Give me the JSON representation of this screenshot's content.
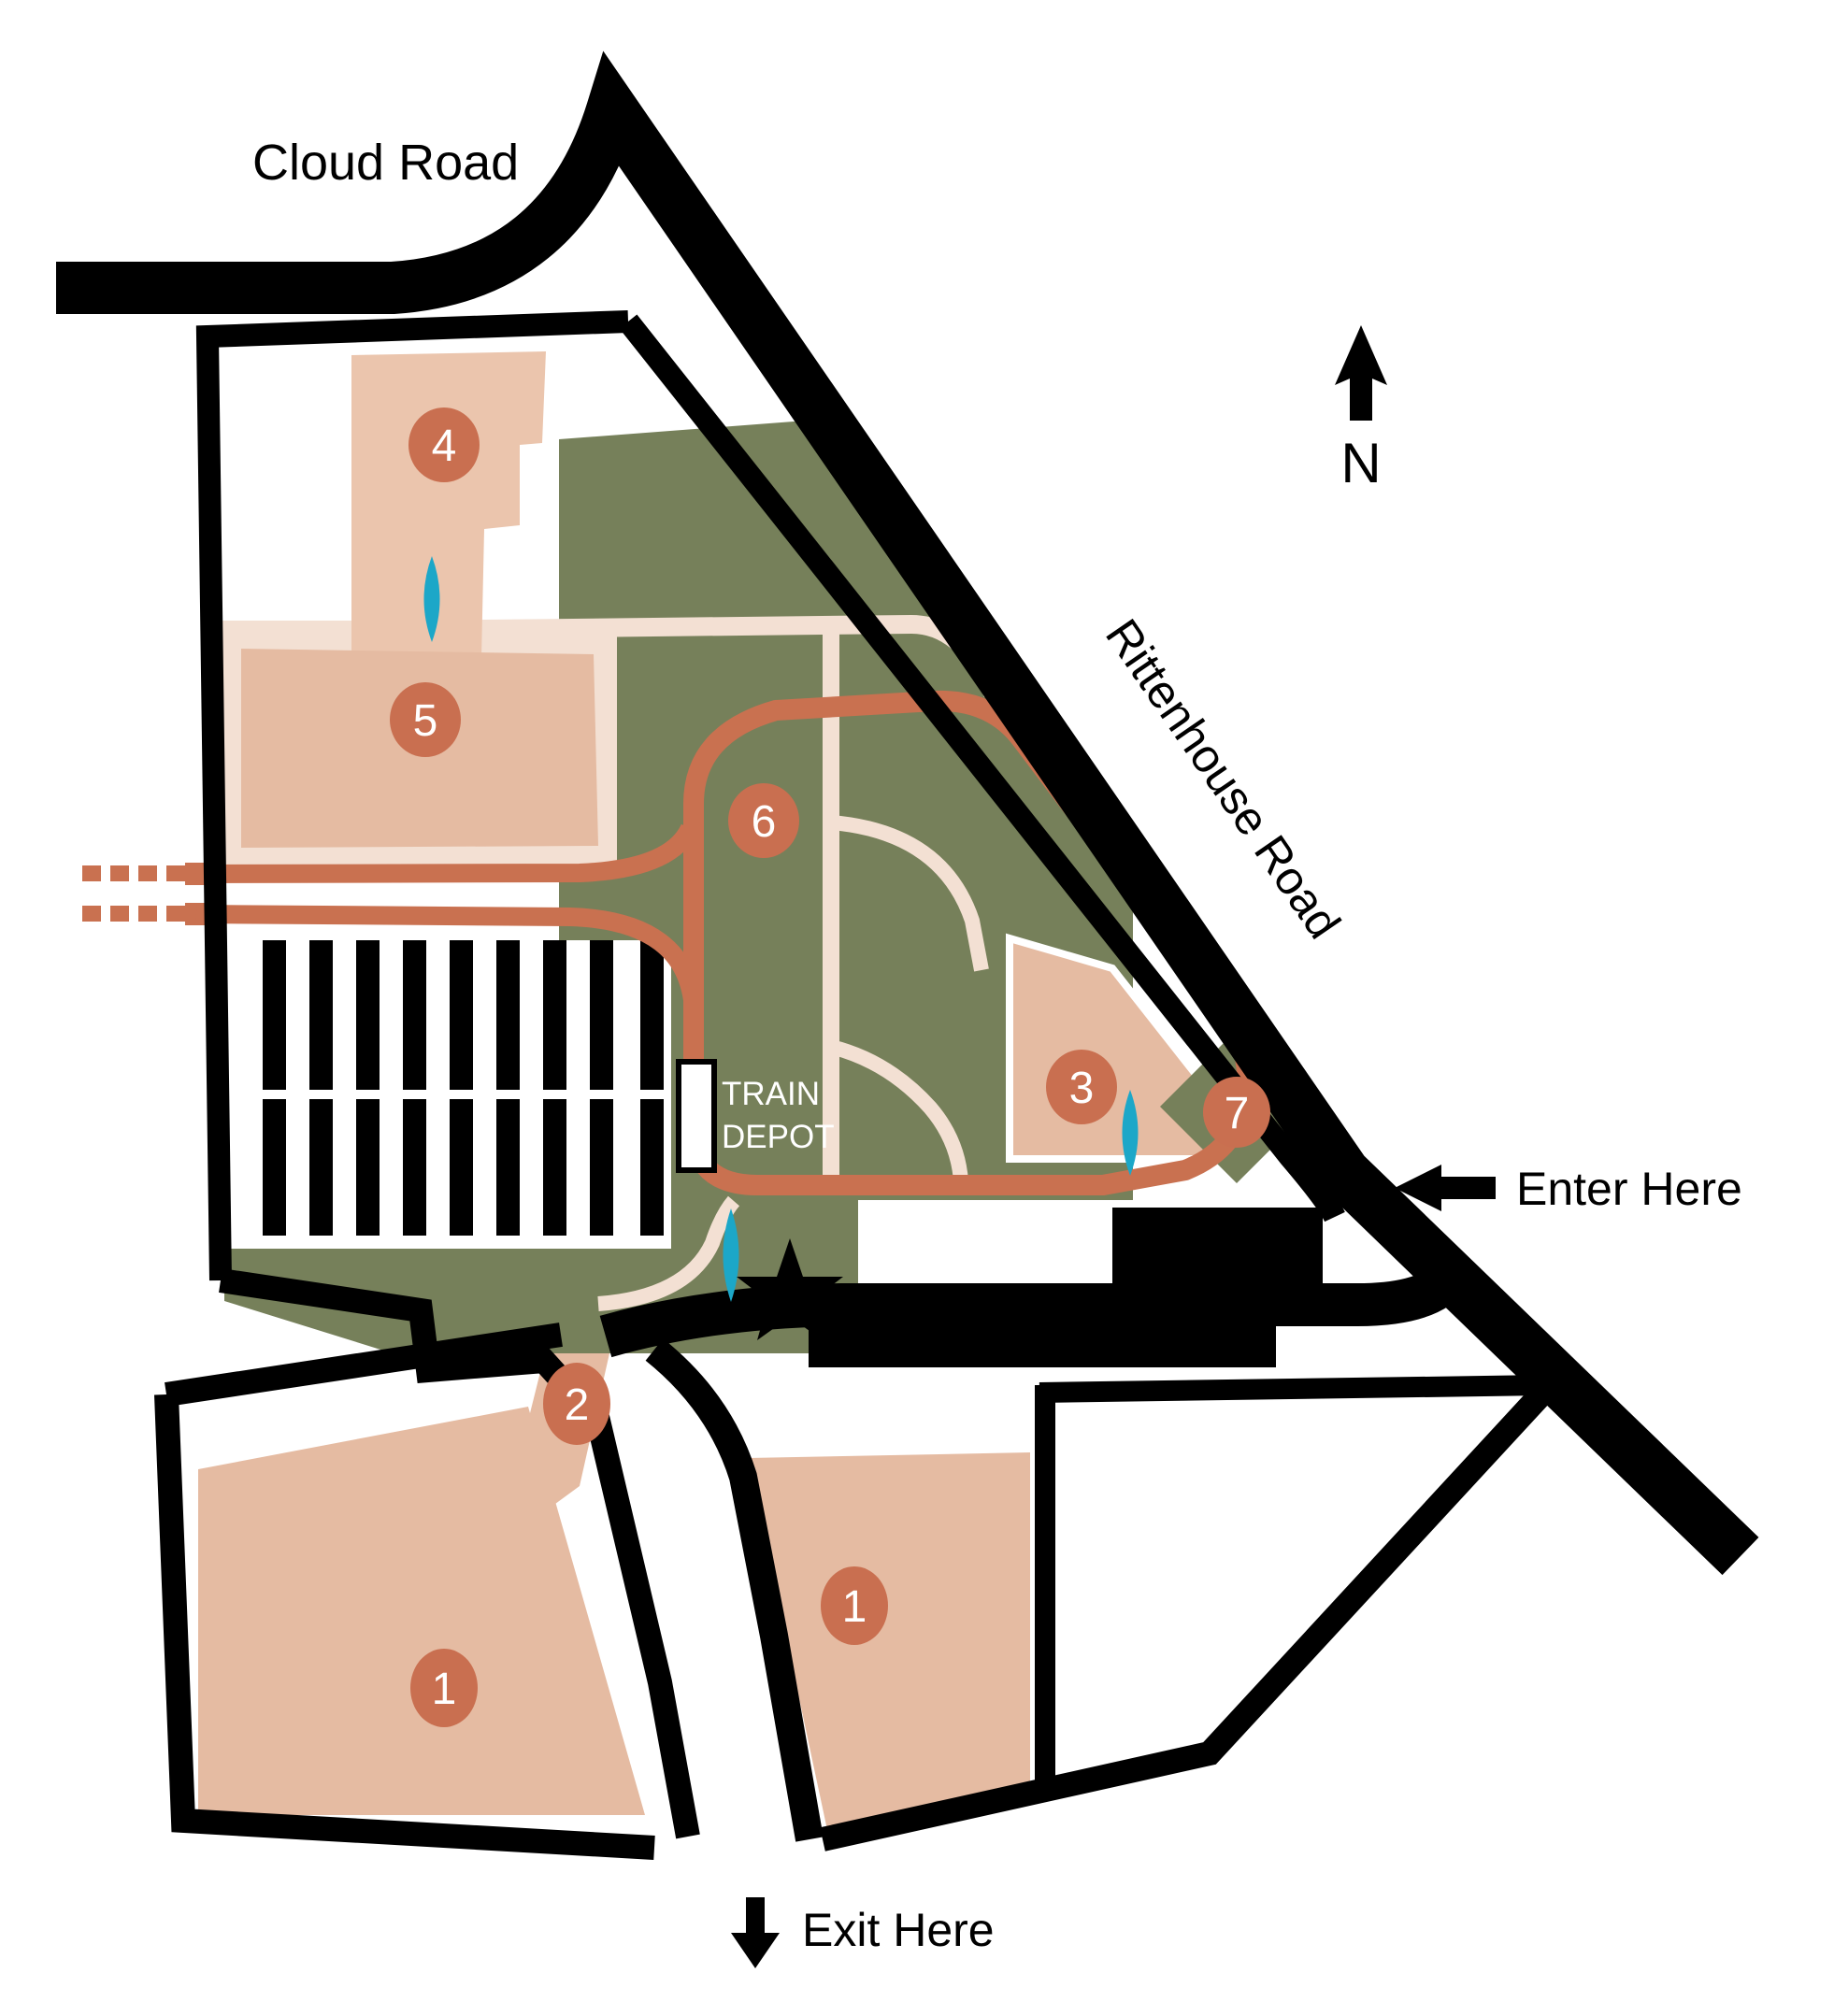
{
  "map": {
    "labels": {
      "cloud_road": "Cloud Road",
      "rittenhouse_road": "Rittenhouse Road",
      "enter_here": "Enter Here",
      "exit_here": "Exit Here",
      "compass_n": "N",
      "train_depot": {
        "line1": "TRAIN",
        "line2": "DEPOT"
      }
    },
    "markers": [
      {
        "id": "area-4",
        "label": "4"
      },
      {
        "id": "area-5",
        "label": "5"
      },
      {
        "id": "area-6",
        "label": "6"
      },
      {
        "id": "area-3",
        "label": "3"
      },
      {
        "id": "area-7",
        "label": "7"
      },
      {
        "id": "area-2",
        "label": "2"
      },
      {
        "id": "area-1-east",
        "label": "1"
      },
      {
        "id": "area-1-west",
        "label": "1"
      }
    ],
    "colors": {
      "road_black": "#000000",
      "lot_tan": "#E5BBA2",
      "path_pale": "#F3E0D3",
      "meadow_olive": "#76805A",
      "track_orange": "#C97150",
      "marker_orange": "#C96F50",
      "water_blue": "#1CA7C8",
      "depot_text_white": "#FFFFFF",
      "background": "#FFFFFF"
    }
  }
}
